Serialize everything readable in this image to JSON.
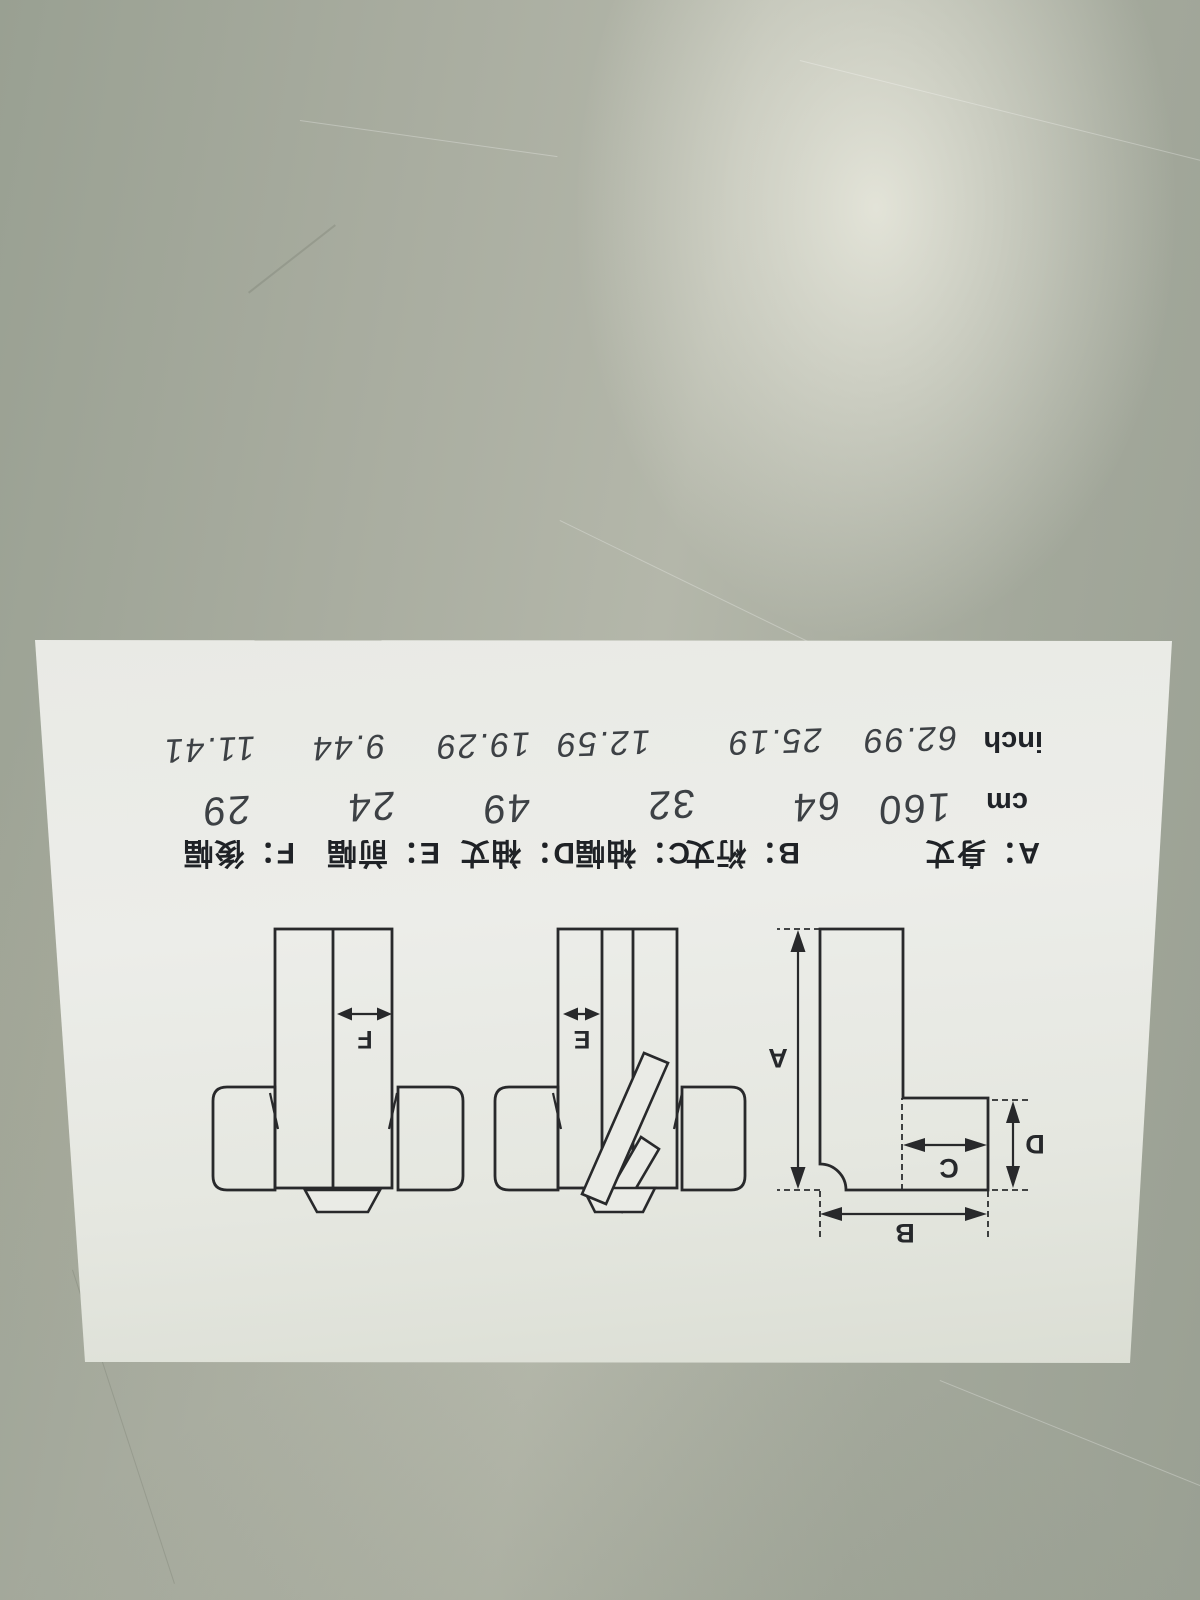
{
  "surface": {
    "description_color": "#a8ac9f",
    "highlight_color": "#ecece1"
  },
  "paper": {
    "legend": {
      "items": [
        {
          "text": "A：身丈"
        },
        {
          "text": "B：裄丈"
        },
        {
          "text": "C：袖幅"
        },
        {
          "text": "D：袖丈"
        },
        {
          "text": "E：前幅"
        },
        {
          "text": "F：後幅"
        }
      ]
    },
    "units": {
      "cm": "cm",
      "inch": "inch"
    },
    "values_cm": [
      "160",
      "64",
      "32",
      "49",
      "24",
      "29"
    ],
    "values_inch": [
      "62.99",
      "25.19",
      "12.59",
      "19.29",
      "9.44",
      "11.41"
    ],
    "diagram_letters": {
      "a": "A",
      "b": "B",
      "c": "C",
      "d": "D",
      "e": "E",
      "f": "F"
    }
  }
}
